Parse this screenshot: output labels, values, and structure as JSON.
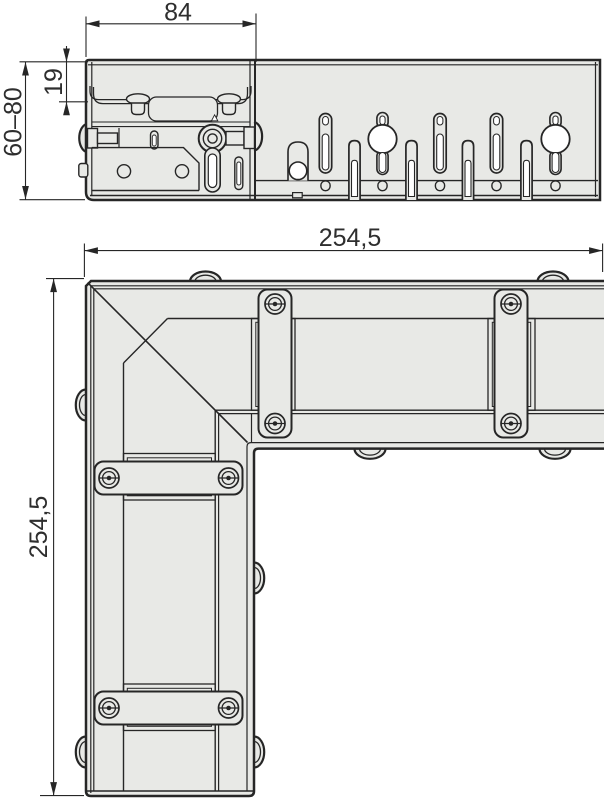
{
  "colors": {
    "background": "#ffffff",
    "line": "#262626",
    "fill": "#e8e9e6",
    "hole": "#ffffff",
    "text": "#2e2e2e"
  },
  "dimensions": {
    "top_width": "84",
    "lip_height": "19",
    "height_range": "60–80",
    "plan_width": "254,5",
    "plan_height": "254,5"
  }
}
